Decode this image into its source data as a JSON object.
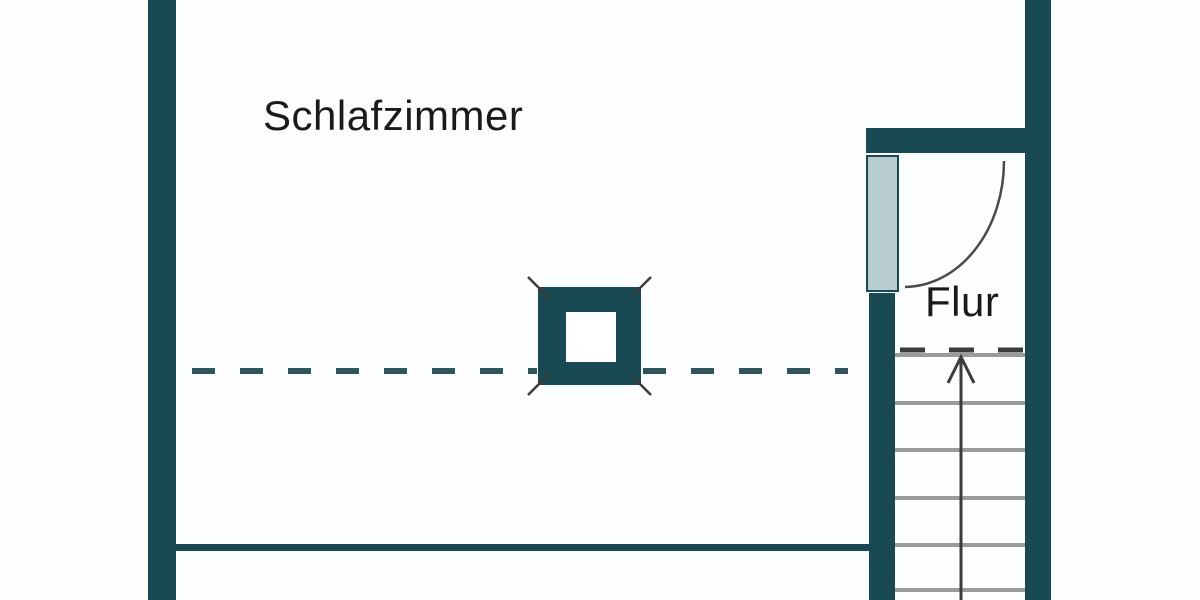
{
  "title": "Floor plan",
  "rooms": {
    "bedroom": {
      "label": "Schlafzimmer"
    },
    "hallway": {
      "label": "Flur"
    }
  },
  "symbols": {
    "door": "door-swing-arc",
    "stairs": "staircase-with-up-arrow",
    "stair_step_count": 6,
    "column": "square-column-with-corner-ticks",
    "section_lines": "dashed"
  },
  "colors": {
    "wall": "#194a53",
    "door_leaf_fill": "#b8cdd2",
    "stair_step": "#9a9a9a",
    "annotation_dark": "#3c3c3c",
    "dashed_line": "#2f545c",
    "text": "#1a1a1a",
    "background": "#fcfdfd"
  }
}
